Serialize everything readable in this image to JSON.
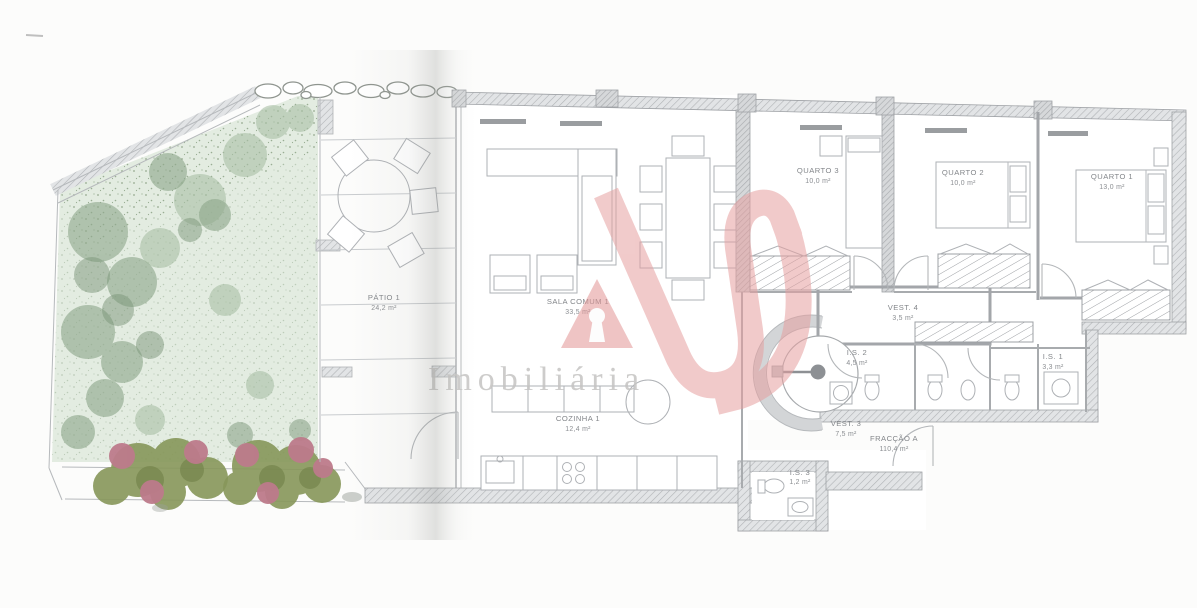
{
  "document": {
    "type": "architectural-floor-plan",
    "description": "Apartment floor plan with garden, photographed brochure page"
  },
  "watermark": {
    "brand": "Imobiliária",
    "logo": "as-monogram",
    "logo_color": "#e6a0a0",
    "logo_triangle_color": "#e29494",
    "text_color": "#c5c4c2"
  },
  "rooms": [
    {
      "name": "PÁTIO 1",
      "area": "24,2 m²"
    },
    {
      "name": "SALA COMUM 1",
      "area": "33,5 m²"
    },
    {
      "name": "COZINHA 1",
      "area": "12,4 m²"
    },
    {
      "name": "QUARTO 3",
      "area": "10,0 m²"
    },
    {
      "name": "QUARTO 2",
      "area": "10,0 m²"
    },
    {
      "name": "QUARTO 1",
      "area": "13,0 m²"
    },
    {
      "name": "VEST. 4",
      "area": "3,5 m²"
    },
    {
      "name": "I.S. 2",
      "area": "4,5 m²"
    },
    {
      "name": "I.S. 1",
      "area": "3,3 m²"
    },
    {
      "name": "VEST. 3",
      "area": "7,5 m²"
    },
    {
      "name": "FRACÇÃO A",
      "area": "110,4 m²"
    },
    {
      "name": "I.S. 3",
      "area": "1,2 m²"
    }
  ],
  "colors": {
    "garden_fill": "#e3ece1",
    "garden_trees": "#8fa88c",
    "shrub_olive": "#87975a",
    "flower_pink": "#bd7b8b",
    "wall_gray": "#a3a6aa",
    "hatch_fill": "#e2e4e6",
    "label_gray": "#83868a"
  }
}
